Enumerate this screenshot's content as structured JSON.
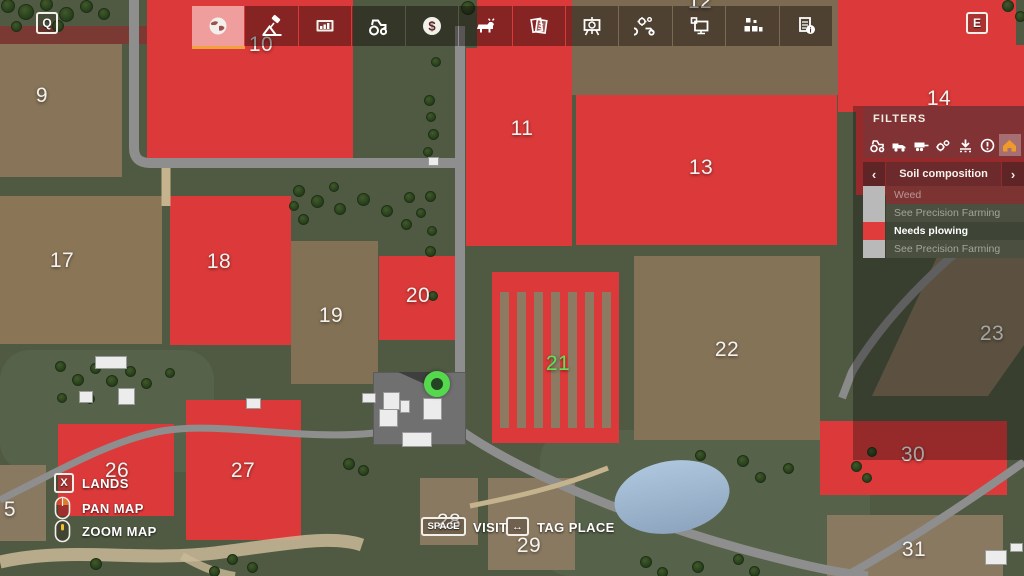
{
  "toolbar": {
    "left_key": "Q",
    "right_key": "E",
    "tabs": [
      {
        "name": "map",
        "selected": true
      },
      {
        "name": "precision-farming",
        "selected": false
      },
      {
        "name": "statistics",
        "selected": false
      },
      {
        "name": "vehicles",
        "selected": false
      },
      {
        "name": "finances",
        "selected": false
      },
      {
        "name": "animals",
        "selected": false
      },
      {
        "name": "contracts",
        "selected": false
      },
      {
        "name": "productions",
        "selected": false
      },
      {
        "name": "maintenance",
        "selected": false
      },
      {
        "name": "placeables",
        "selected": false
      },
      {
        "name": "storage",
        "selected": false
      },
      {
        "name": "prices",
        "selected": false
      }
    ],
    "selected_underline_color": "#f2a23c"
  },
  "filters": {
    "title": "FILTERS",
    "icons": [
      "tractor",
      "truck",
      "trailer",
      "gears",
      "unload",
      "alert",
      "house"
    ],
    "selected_icon": "house",
    "selected_icon_color": "#f09a2c",
    "category": "Soil composition",
    "prev_arrow": "‹",
    "next_arrow": "›",
    "rows": [
      {
        "label": "Weed",
        "swatch": "#b9b9b9",
        "dim": true
      },
      {
        "label": "See Precision Farming",
        "swatch": "#b9b9b9",
        "dim": true
      },
      {
        "label": "Needs plowing",
        "swatch": "#e03c3c",
        "dim": false
      },
      {
        "label": "See Precision Farming",
        "swatch": "#b9b9b9",
        "dim": true
      }
    ]
  },
  "hints": {
    "lands": {
      "key": "X",
      "label": "LANDS"
    },
    "pan": {
      "label": "PAN MAP"
    },
    "zoom": {
      "label": "ZOOM MAP"
    },
    "visit": {
      "key": "SPACE",
      "label": "VISIT"
    },
    "tag": {
      "key": "↔",
      "label": "TAG PLACE"
    }
  },
  "map": {
    "player_marker_color": "#55d84d",
    "owned_label_color": "#5fe257",
    "label_color": "#f4f2ee",
    "needs_plowing_color": "#dc3a3a",
    "fields": [
      {
        "label": "5",
        "x": 10,
        "y": 510,
        "owned": false
      },
      {
        "label": "9",
        "x": 42,
        "y": 96,
        "owned": false
      },
      {
        "label": "10",
        "x": 261,
        "y": 45,
        "owned": false
      },
      {
        "label": "11",
        "x": 522,
        "y": 129,
        "owned": false
      },
      {
        "label": "12",
        "x": 700,
        "y": 2,
        "owned": false
      },
      {
        "label": "13",
        "x": 701,
        "y": 168,
        "owned": false
      },
      {
        "label": "14",
        "x": 939,
        "y": 99,
        "owned": false
      },
      {
        "label": "17",
        "x": 62,
        "y": 261,
        "owned": false
      },
      {
        "label": "18",
        "x": 219,
        "y": 262,
        "owned": false
      },
      {
        "label": "19",
        "x": 331,
        "y": 316,
        "owned": false
      },
      {
        "label": "20",
        "x": 418,
        "y": 296,
        "owned": false
      },
      {
        "label": "21",
        "x": 558,
        "y": 364,
        "owned": true
      },
      {
        "label": "22",
        "x": 727,
        "y": 350,
        "owned": false
      },
      {
        "label": "23",
        "x": 992,
        "y": 334,
        "owned": false
      },
      {
        "label": "26",
        "x": 117,
        "y": 471,
        "owned": false
      },
      {
        "label": "27",
        "x": 243,
        "y": 471,
        "owned": false
      },
      {
        "label": "28",
        "x": 449,
        "y": 522,
        "owned": false
      },
      {
        "label": "29",
        "x": 529,
        "y": 546,
        "owned": false
      },
      {
        "label": "30",
        "x": 913,
        "y": 455,
        "owned": false
      },
      {
        "label": "31",
        "x": 914,
        "y": 550,
        "owned": false
      }
    ]
  }
}
